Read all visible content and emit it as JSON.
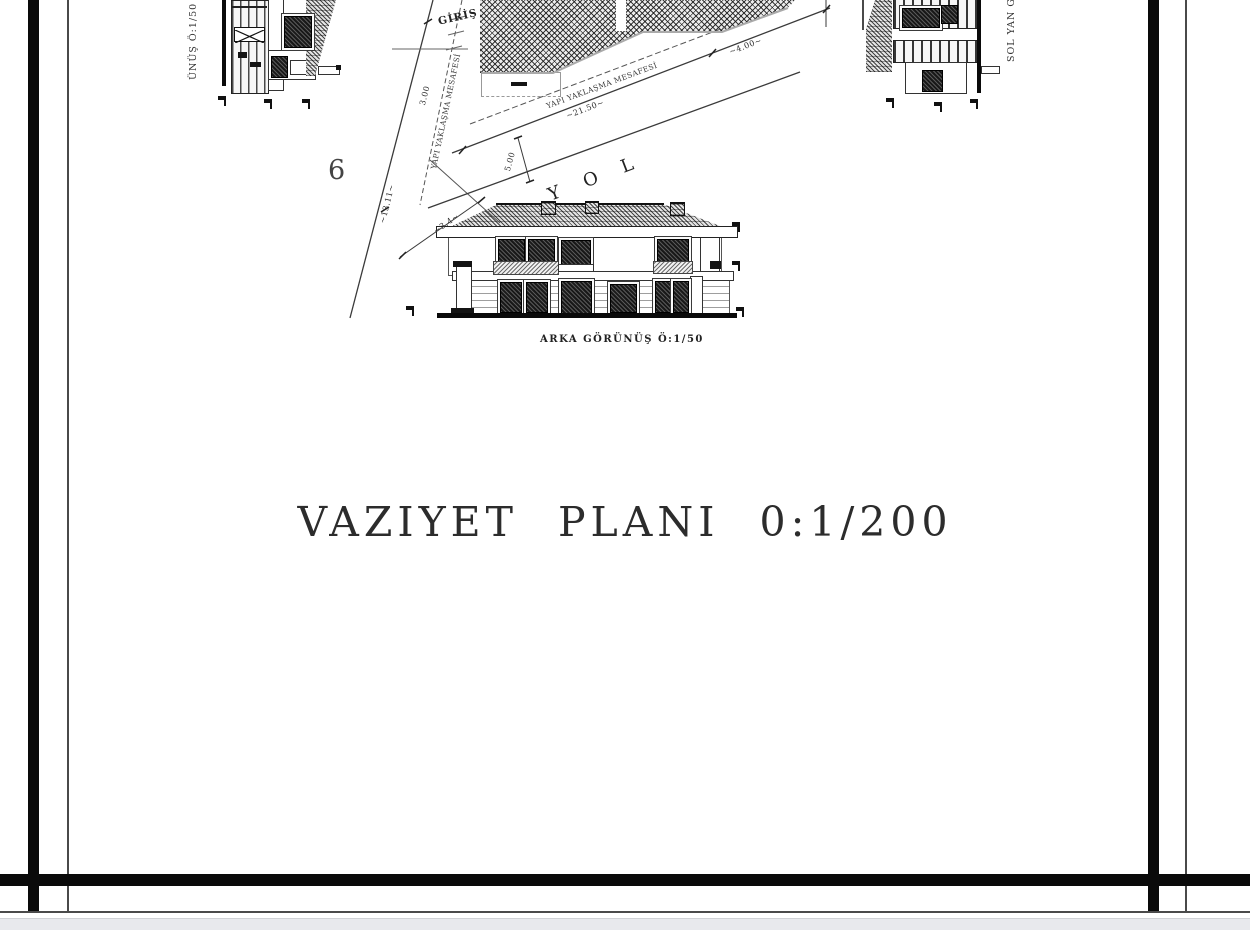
{
  "title": "VAZIYET PLANI 0:1/200",
  "labels": {
    "plot_number": "6",
    "road": "Y O L",
    "entrance": "GİRİŞ",
    "rear_view": "ARKA GÖRÜNÜŞ Ö:1/50",
    "front_view_partial": "ÜNÜŞ Ö:1/50",
    "side_view_partial": "SOL YAN G",
    "setback_road": "YAPI YAKLAŞMA MESAFESİ",
    "setback_left": "YAPI YAKLAŞMA MESAFESİ"
  },
  "dimensions": {
    "road_frontage": "~21.50~",
    "frontage_right": "~4.00~",
    "road_width": "5.00",
    "setback_width": "3.00",
    "left_boundary": "~13.11~",
    "corner": "~3.4~"
  },
  "colors": {
    "paper": "#ffffff",
    "ink": "#1f1f1f",
    "frame": "#000000",
    "muted_line": "#9a9a9a",
    "viewer_strip": "#e8e9ed"
  }
}
